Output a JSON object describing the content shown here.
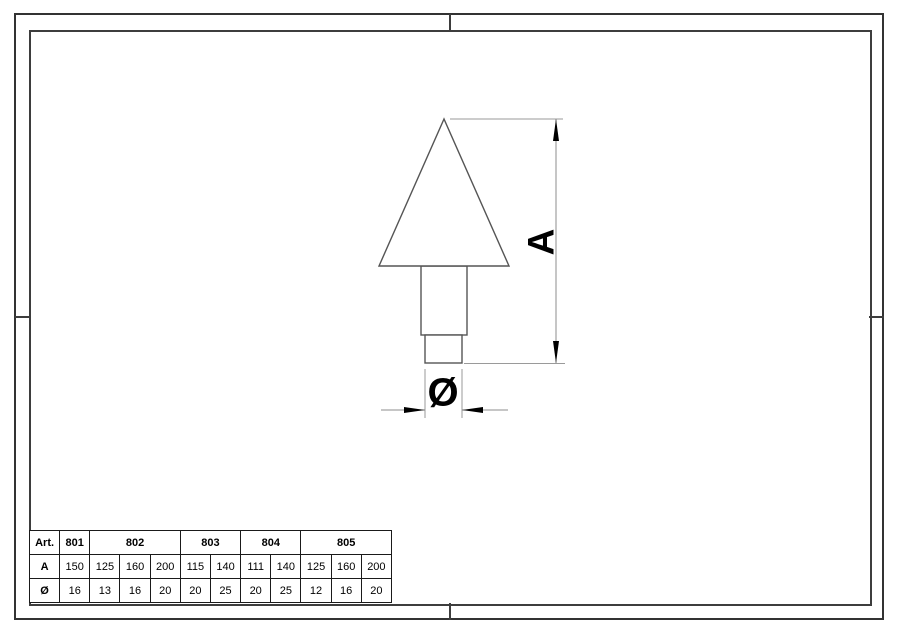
{
  "drawing": {
    "dim_a_label": "A",
    "dim_diameter_label": "Ø",
    "shape_line_color": "#555555",
    "dimension_line_color": "#8c8c8c",
    "arrow_color": "#000000",
    "frame_color": "#333333"
  },
  "table": {
    "row_headers": [
      "Art.",
      "A",
      "Ø"
    ],
    "art_groups": [
      {
        "label": "801",
        "span": 1
      },
      {
        "label": "802",
        "span": 3
      },
      {
        "label": "803",
        "span": 2
      },
      {
        "label": "804",
        "span": 2
      },
      {
        "label": "805",
        "span": 3
      }
    ],
    "a_values": [
      "150",
      "125",
      "160",
      "200",
      "115",
      "140",
      "111",
      "140",
      "125",
      "160",
      "200"
    ],
    "diameter_values": [
      "16",
      "13",
      "16",
      "20",
      "20",
      "25",
      "20",
      "25",
      "12",
      "16",
      "20"
    ]
  }
}
